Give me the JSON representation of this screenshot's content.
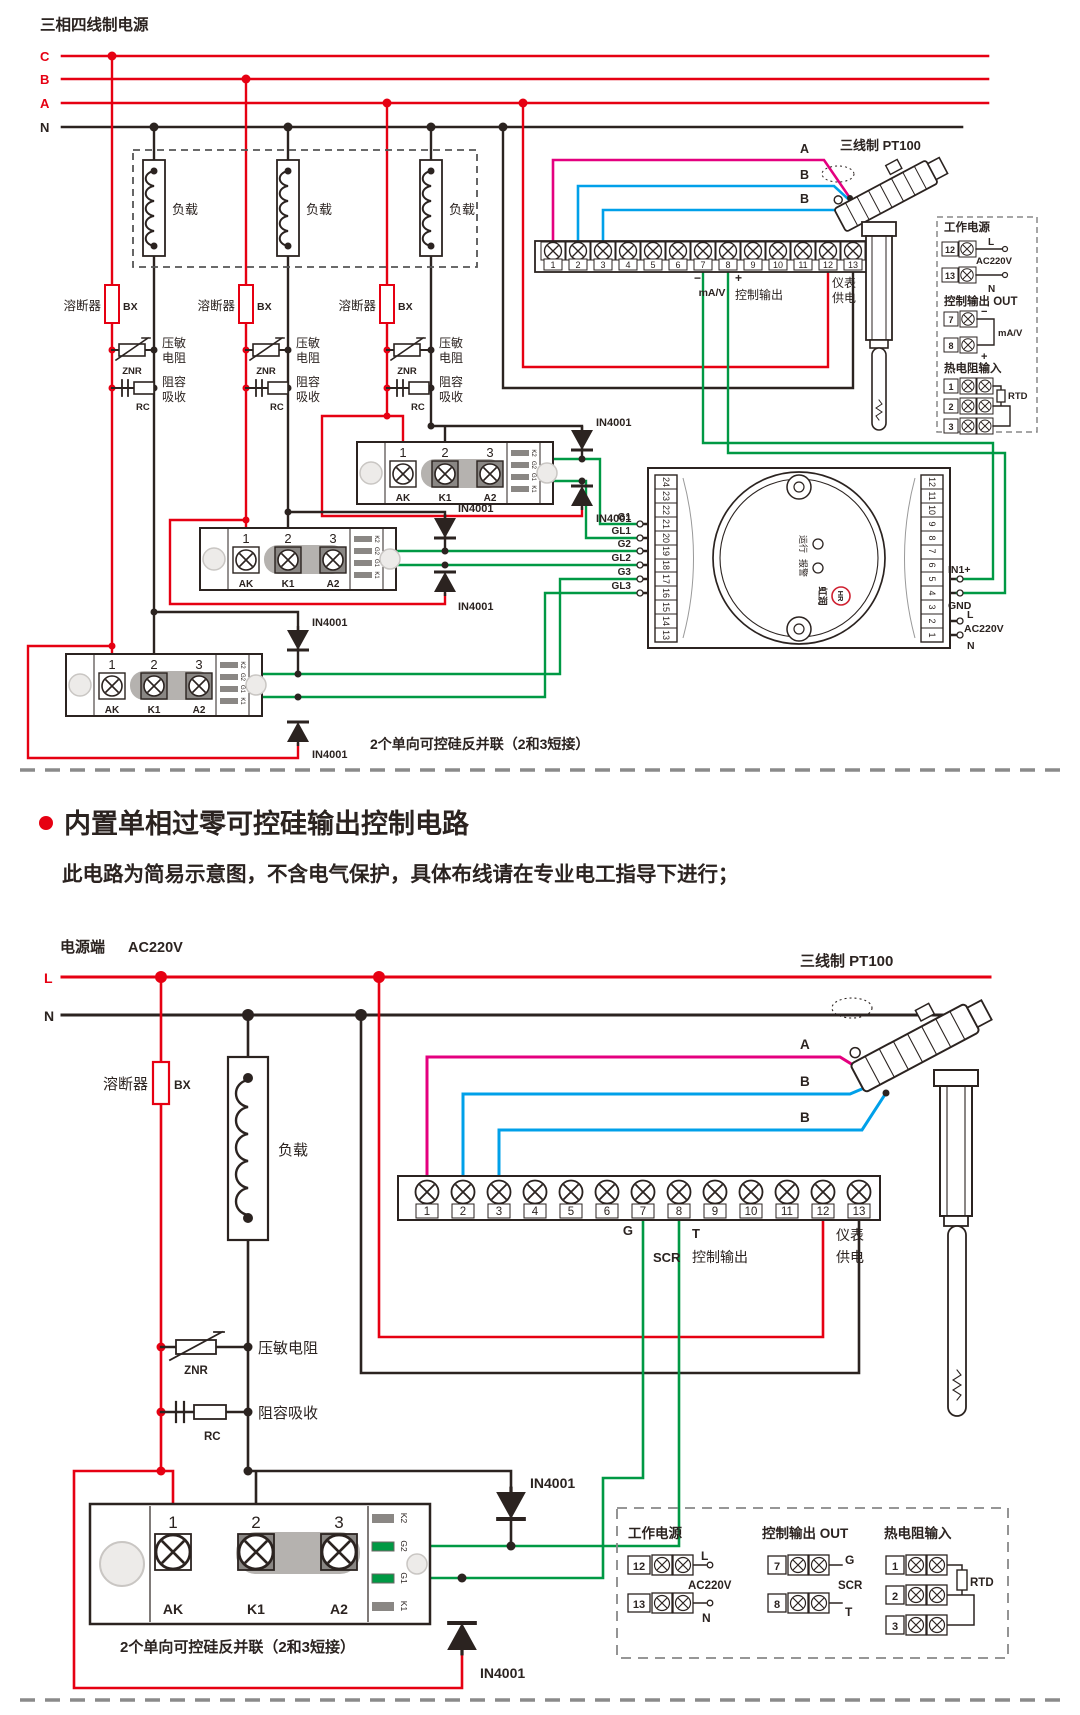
{
  "colors": {
    "line_red": "#e60012",
    "wire_black": "#2b2320",
    "wire_magenta": "#e4007f",
    "wire_blue": "#00a0e9",
    "wire_green": "#009944"
  },
  "top": {
    "title": "三相四线制电源",
    "phase_c": "C",
    "phase_b": "B",
    "phase_a": "A",
    "phase_n": "N",
    "load": "负载",
    "fuse": "溶断器",
    "fuse_code": "BX",
    "znr_1": "压敏",
    "znr_2": "电阻",
    "znr_code": "ZNR",
    "rc_1": "阻容",
    "rc_2": "吸收",
    "rc_code": "RC",
    "diode": "IN4001",
    "module": {
      "t1": "1",
      "t2": "2",
      "t3": "3",
      "p1": "AK",
      "p2": "K1",
      "p3": "A2",
      "s1": "K2",
      "s2": "G2",
      "s3": "G1",
      "s4": "K1"
    },
    "caption": "2个单向可控硅反并联（2和3短接）",
    "strip": [
      "1",
      "2",
      "3",
      "4",
      "5",
      "6",
      "7",
      "8",
      "9",
      "10",
      "11",
      "12",
      "13"
    ],
    "wire_a": "A",
    "wire_b1": "B",
    "wire_b2": "B",
    "sensor": "三线制 PT100",
    "minus": "−",
    "unit": "mA/V",
    "plus": "+",
    "ctrl_out": "控制输出",
    "meter_1": "仪表",
    "meter_2": "供电",
    "gates": [
      "G1",
      "GL1",
      "G2",
      "GL2",
      "G3",
      "GL3"
    ],
    "panel": {
      "power": "工作电源",
      "n12": "12",
      "n13": "13",
      "l": "L",
      "ac": "AC220V",
      "n": "N",
      "out": "控制输出 OUT",
      "n7": "7",
      "n8": "8",
      "minus": "−",
      "unit": "mA/V",
      "plus": "+",
      "rtd_title": "热电阻输入",
      "n1": "1",
      "n2": "2",
      "n3": "3",
      "rtd": "RTD"
    },
    "ctrl": {
      "left": [
        "24",
        "23",
        "22",
        "21",
        "20",
        "19",
        "18",
        "17",
        "16",
        "15",
        "14",
        "13"
      ],
      "right": [
        "12",
        "11",
        "10",
        "9",
        "8",
        "7",
        "6",
        "5",
        "4",
        "3",
        "2",
        "1"
      ],
      "in1": "IN1+",
      "gnd": "GND",
      "l": "L",
      "ac": "AC220V",
      "n": "N",
      "ind1": "运行",
      "ind2": "报警",
      "brand": "虹润",
      "logo": "HR"
    }
  },
  "middle": {
    "heading": "内置单相过零可控硅输出控制电路",
    "subheading": "此电路为简易示意图，不含电气保护，具体布线请在专业电工指导下进行；"
  },
  "bottom": {
    "source": "电源端",
    "source_v": "AC220V",
    "l": "L",
    "n": "N",
    "fuse": "溶断器",
    "fuse_code": "BX",
    "load": "负载",
    "znr": "压敏电阻",
    "znr_code": "ZNR",
    "rc": "阻容吸收",
    "rc_code": "RC",
    "diode": "IN4001",
    "strip": [
      "1",
      "2",
      "3",
      "4",
      "5",
      "6",
      "7",
      "8",
      "9",
      "10",
      "11",
      "12",
      "13"
    ],
    "wire_a": "A",
    "wire_b1": "B",
    "wire_b2": "B",
    "sensor": "三线制 PT100",
    "g": "G",
    "scr": "SCR",
    "t": "T",
    "ctrl_out": "控制输出",
    "meter_1": "仪表",
    "meter_2": "供电",
    "module": {
      "t1": "1",
      "t2": "2",
      "t3": "3",
      "p1": "AK",
      "p2": "K1",
      "p3": "A2",
      "s1": "K2",
      "s2": "G2",
      "s3": "G1",
      "s4": "K1"
    },
    "caption": "2个单向可控硅反并联（2和3短接）",
    "legend": {
      "power": "工作电源",
      "n12": "12",
      "n13": "13",
      "l": "L",
      "ac": "AC220V",
      "n": "N",
      "out": "控制输出 OUT",
      "n7": "7",
      "n8": "8",
      "g": "G",
      "scr": "SCR",
      "t": "T",
      "rtd_title": "热电阻输入",
      "n1": "1",
      "n2": "2",
      "n3": "3",
      "rtd": "RTD"
    }
  }
}
